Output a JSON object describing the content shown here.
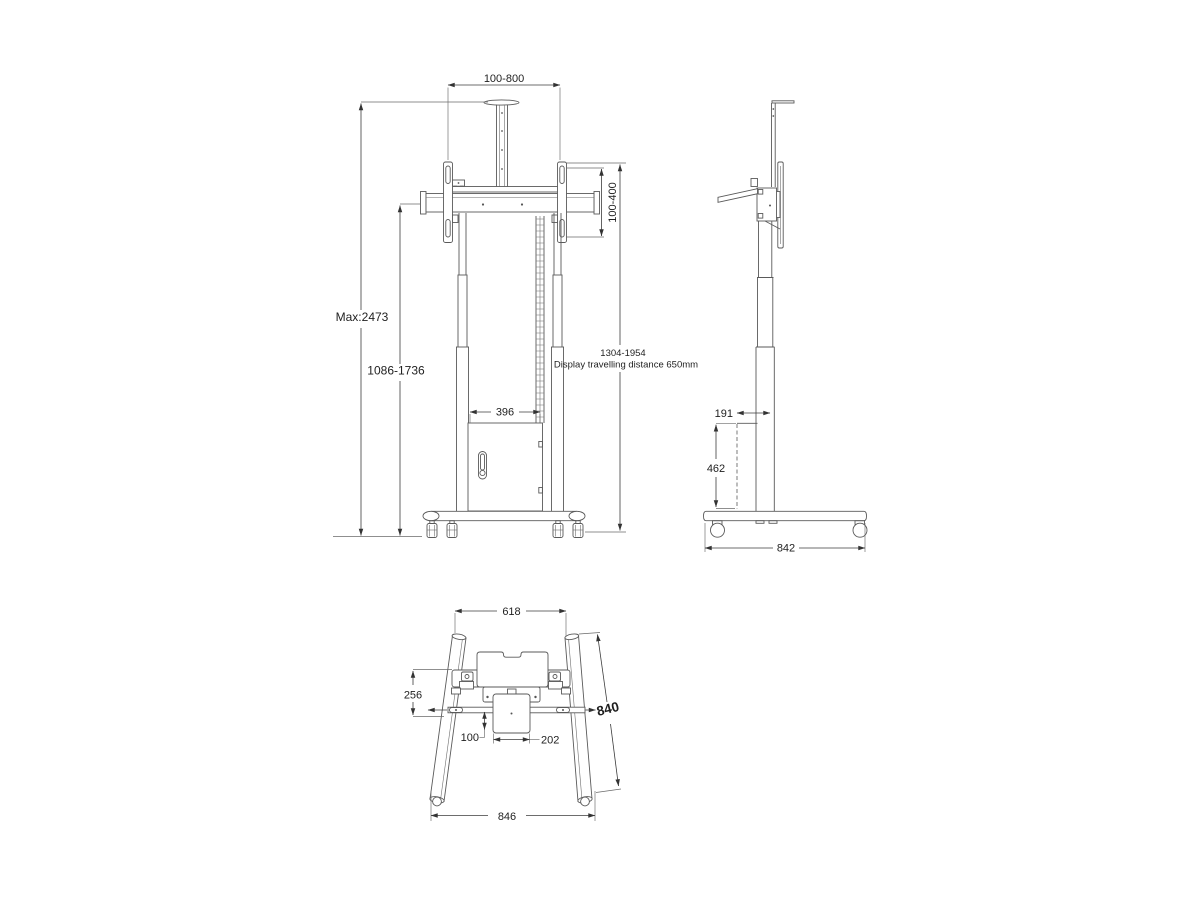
{
  "page": {
    "background": "#ffffff",
    "line_color": "#5a5a5a",
    "text_color": "#1f1f1f"
  },
  "front_view": {
    "width_range": "100-800",
    "vesa_range": "100-400",
    "max_height": "Max:2473",
    "height_range": "1086-1736",
    "travel_range": "1304-1954",
    "travel_note": "Display travelling distance 650mm",
    "cabinet_width": "396"
  },
  "side_view": {
    "top_offset": "191",
    "cabinet_height": "462",
    "base_depth": "842"
  },
  "top_view": {
    "top_width": "618",
    "plate_depth": "256",
    "leg_length": "840",
    "column_offset": "100",
    "plate_width": "202",
    "base_width": "846"
  }
}
